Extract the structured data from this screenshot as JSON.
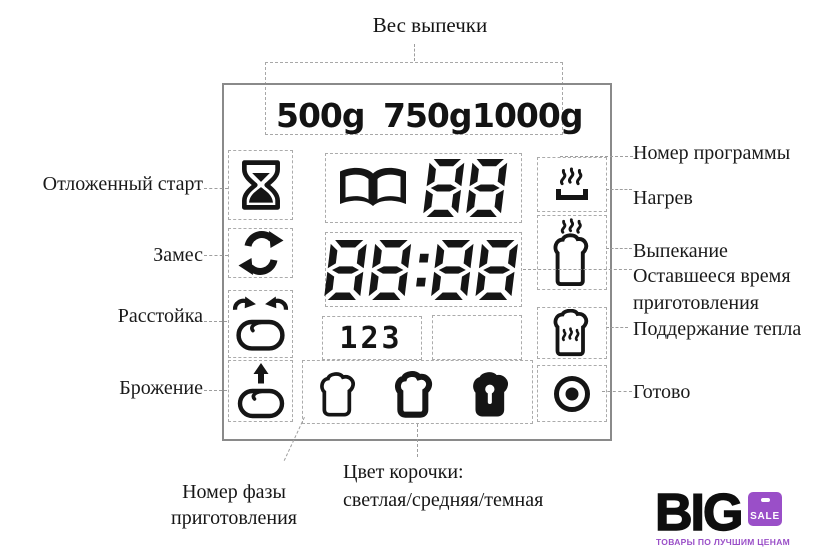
{
  "title": "Вес выпечки",
  "colors": {
    "purple": "#9a4fc8",
    "ink": "#151515",
    "box_border": "#8a8a8a",
    "dash_gray": "#a8a8a8"
  },
  "display": {
    "weights": [
      "500g",
      "750g",
      "1000g"
    ],
    "program_number": "88",
    "time": "88:88",
    "phase_digits": "123"
  },
  "left_labels": {
    "delayed_start": "Отложенный старт",
    "knead": "Замес",
    "proof": "Расстойка",
    "ferment": "Брожение"
  },
  "right_labels": {
    "program_number": "Номер программы",
    "heating": "Нагрев",
    "baking": "Выпекание",
    "remaining_time_1": "Оставшееся время",
    "remaining_time_2": "приготовления",
    "keep_warm": "Поддержание тепла",
    "ready": "Готово"
  },
  "bottom_labels": {
    "phase_line1": "Номер фазы",
    "phase_line2": "приготовления",
    "crust_line1": "Цвет корочки:",
    "crust_line2": "светлая/средняя/темная"
  },
  "logo": {
    "name": "BIG",
    "badge": "SALE",
    "tagline": "ТОВАРЫ ПО ЛУЧШИМ ЦЕНАМ"
  }
}
